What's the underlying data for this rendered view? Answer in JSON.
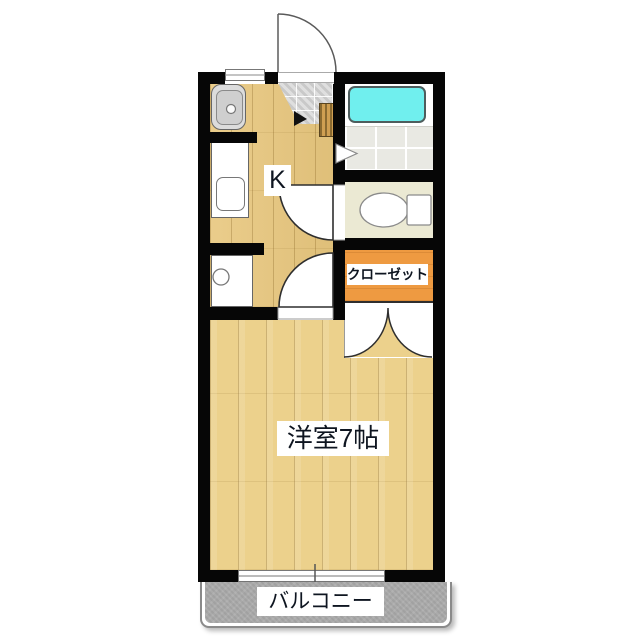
{
  "labels": {
    "kitchen": "K",
    "closet": "クローゼット",
    "western_room": "洋室7帖",
    "balcony": "バルコニー"
  },
  "colors": {
    "wall": "#060606",
    "kitchen_floor": "#e8c77e",
    "room_floor": "#ecd18c",
    "closet": "#ee9a41",
    "bathtub": "#70efee",
    "toilet_floor": "#ebe9d3",
    "balcony": "#ababab",
    "genkan_tile": "#d4d4d4"
  }
}
